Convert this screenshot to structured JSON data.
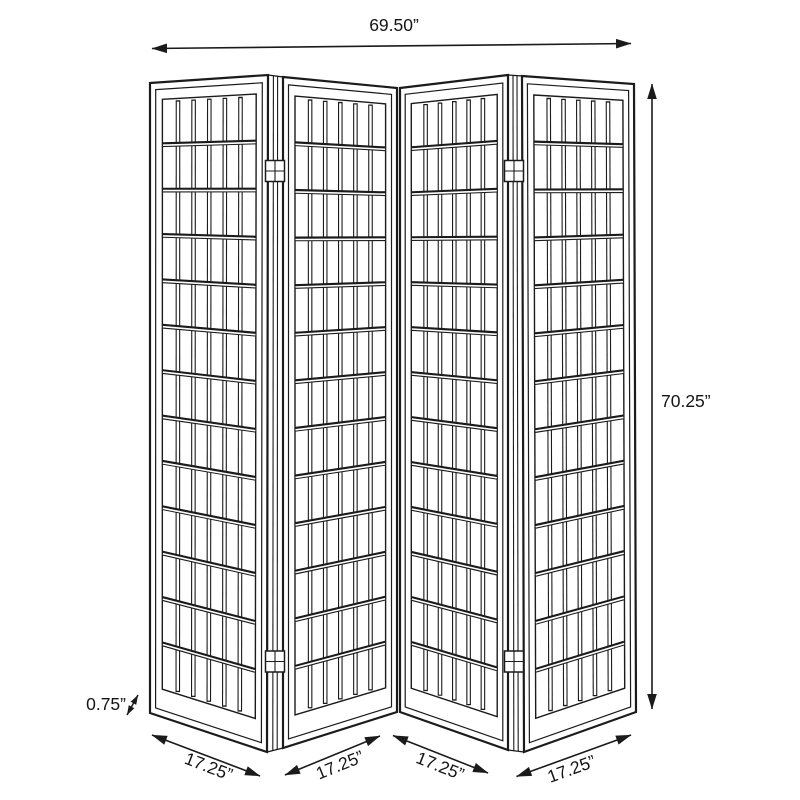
{
  "dimensions": {
    "total_width": "69.50”",
    "total_height": "70.25”",
    "panel_thickness": "0.75”",
    "panel_widths": [
      "17.25”",
      "17.25”",
      "17.25”",
      "17.25”"
    ]
  },
  "structure": {
    "panel_count": 4,
    "grid_columns": 6,
    "grid_rows": 13,
    "hinge_count": 4
  },
  "style": {
    "ink": "#1b1b1b",
    "background": "#ffffff"
  }
}
